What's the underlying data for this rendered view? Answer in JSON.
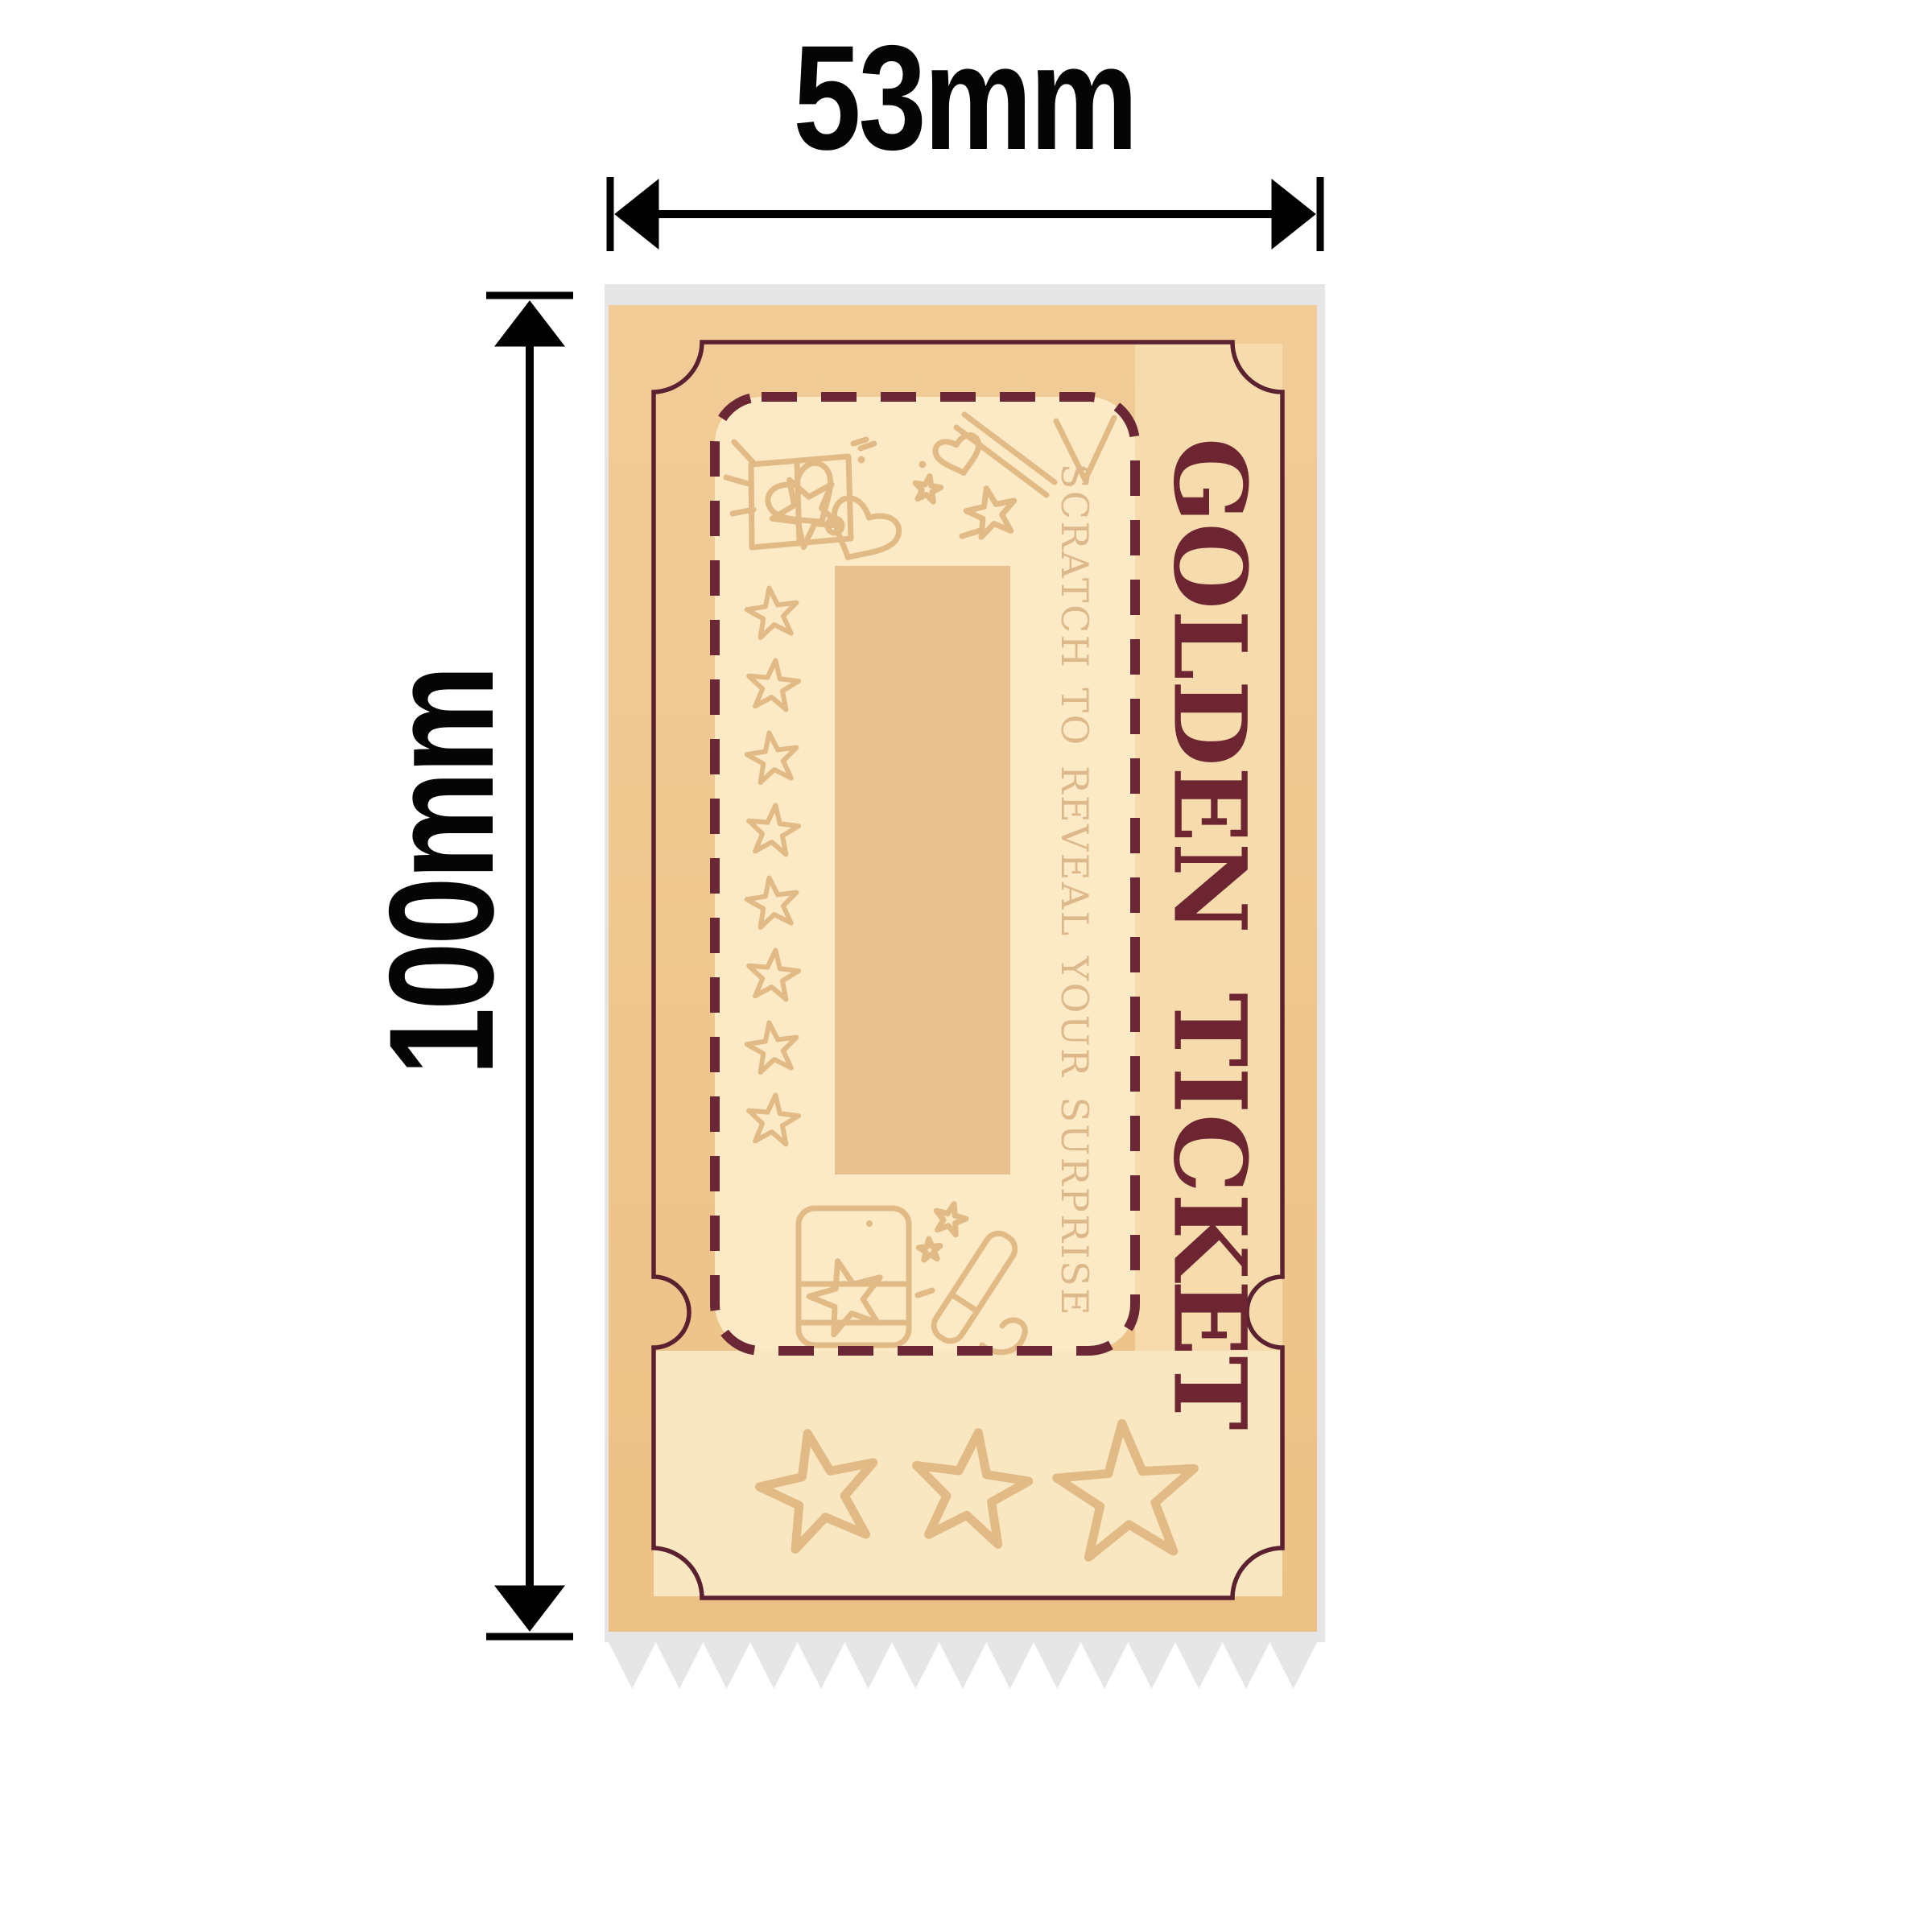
{
  "annotation": {
    "width_label": "53mm",
    "height_label": "100mm",
    "arrow_color": "#000000"
  },
  "ticket": {
    "title": "GOLDEN TICKET",
    "scratch_hint": "SCRATCH TO REVEAL YOUR SURPRISE",
    "colors": {
      "backing_gray": "#e7e6e7",
      "base_tan": "#efc78e",
      "inner_cream": "#fbeac5",
      "right_column_cream": "#f6dcac",
      "stub_cream": "#f9e7c1",
      "border_maroon": "#5c2130",
      "dashed_maroon": "#6b2736",
      "title_maroon": "#6d2532",
      "hint_gold": "#ddb88a",
      "line_art_gold": "#e2ba85",
      "scratch_area_tan": "#e9c190"
    },
    "icons": [
      "gift-box-icon",
      "bow-heart-icon",
      "magic-wand-icon",
      "sparkle-icon",
      "star-icon",
      "heart-icon",
      "party-popper-icon",
      "serrated-edge"
    ]
  }
}
